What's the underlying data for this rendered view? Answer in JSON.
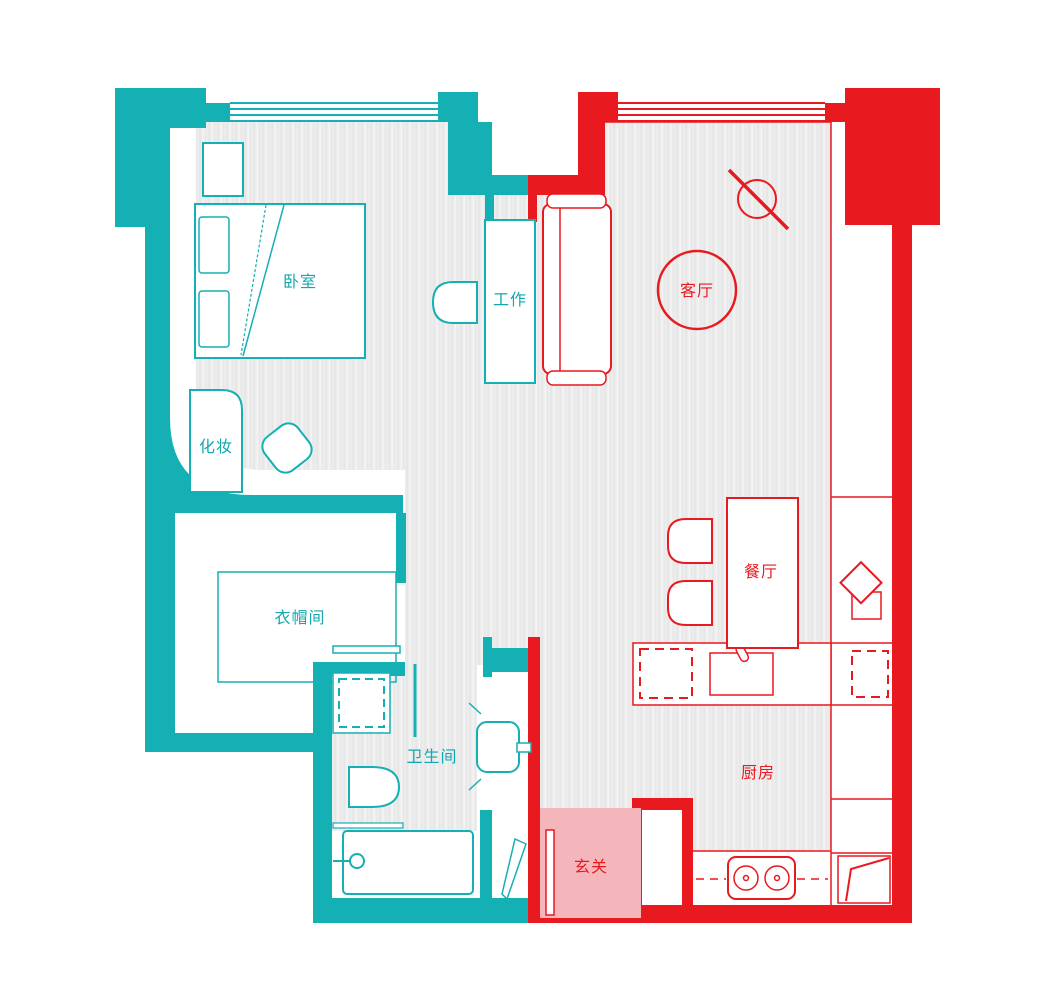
{
  "meta": {
    "type": "apartment-floor-plan",
    "style": "two-tone color-blocked plan"
  },
  "colors": {
    "teal_zone": "#14b0b4",
    "red_zone": "#e8191f",
    "entry_pink": "#f5b6bb",
    "floor_gray": "#ececec",
    "background": "#ffffff"
  },
  "zones": {
    "teal": {
      "accent": "#14b0b4",
      "rooms": [
        "卧室",
        "工作",
        "化妆",
        "衣帽间",
        "卫生间"
      ]
    },
    "red": {
      "accent": "#e8191f",
      "rooms": [
        "客厅",
        "餐厅",
        "厨房",
        "玄关"
      ]
    }
  },
  "labels": {
    "bedroom": "卧室",
    "work": "工作",
    "makeup": "化妆",
    "cloakroom": "衣帽间",
    "bathroom": "卫生间",
    "living": "客厅",
    "dining": "餐厅",
    "kitchen": "厨房",
    "entry": "玄关"
  }
}
